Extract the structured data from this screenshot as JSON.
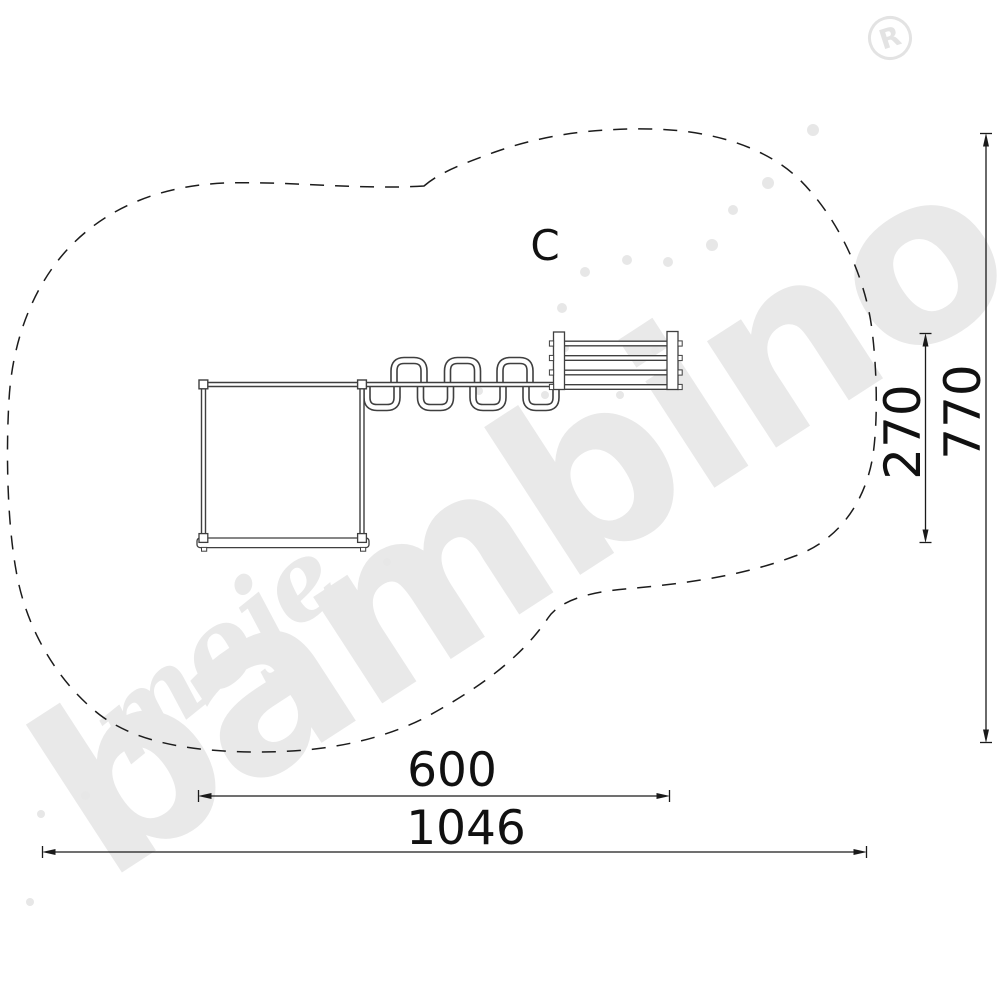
{
  "drawing": {
    "label_c": "C",
    "dimensions": {
      "item_length": "600",
      "item_depth": "270",
      "safety_zone_length": "1046",
      "safety_zone_depth": "770"
    }
  },
  "watermark": {
    "word_script": "moje",
    "word_brand": "bambino",
    "registered": "R"
  },
  "colors": {
    "dimension_line": "#1a1a1a",
    "outline_dash": "#1c1c1c",
    "equipment_line": "#3f3f3f",
    "watermark_gray": "#e9e9e9",
    "background": "#ffffff"
  }
}
